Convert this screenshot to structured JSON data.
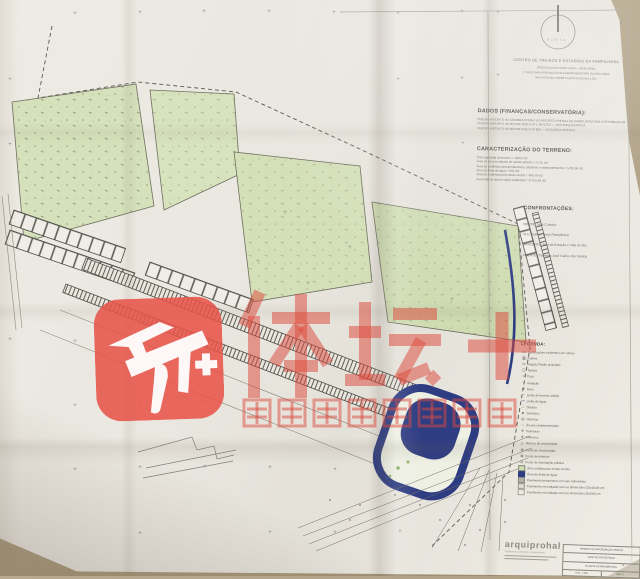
{
  "watermark": {
    "icon_name": "tiyu-tan-plus-app-icon",
    "main_text": "体坛+",
    "subtitle": "体坛周报新闻客户端",
    "color": "#dd4a3e"
  },
  "north": {
    "label": "NORTE"
  },
  "header": {
    "lines": [
      "CENTRO DE TREINOS E ESTÁGIOS DA PAMPILHOSA",
      "(FREGUESIA DA PAMPILHOSA — MEALHADA)",
      "1ª FASE PARA APROVAÇÃO NA CÂMARA MUNICIPAL DA MEALHADA",
      "IMPLANTAÇÃO SOBRE PLANTA À ESCALA 1:500"
    ]
  },
  "dados": {
    "title": "DADOS (FINANÇAS/CONSERVATÓRIA):",
    "lines": [
      "PRÉDIO INSCRITO NA CONSERVATÓRIA DO REGISTO PREDIAL DE PAMPILHOSA SOB O Nº 01821/91-03",
      "PRÉDIO INSCRITO NA MATRIZ SOB O Nº 1 SECÇÃO — NATUREZA RÚSTICA",
      "PRÉDIO INSCRITO NA MATRIZ SOB O Nº 820 — NATUREZA RÚSTICA"
    ]
  },
  "terreno": {
    "title": "CARACTERIZAÇÃO DO TERRENO:",
    "lines": [
      "Área registada do terreno = 49255 m2",
      "Área do terreno objecto do estudo anterior = 5755 m2",
      "Área de cedência para arruamentos, passeios e estacionamentos = 5782,36 m2",
      "Área da linha de água = 650 m2",
      "Área de cedência para zonas verdes = 968,70 m2",
      "Área final do terreno após cedências = 37755,36 m2"
    ]
  },
  "confrontacoes": {
    "title": "CONFRONTAÇÕES:",
    "lines": [
      "NORTE: José Curinha",
      "SUL: Rua do Brejo Pampilhosa",
      "NASCENTE: Rua da Estação e Vale do Rio",
      "POENTE: Travessa José Carlos dos Santos"
    ]
  },
  "legenda": {
    "title": "LEGENDA:",
    "items": [
      {
        "glyph": "▭",
        "chip": "",
        "label": "Construções existentes em ruínas"
      },
      {
        "glyph": "▥",
        "chip": "",
        "label": "Ruínas"
      },
      {
        "glyph": "═",
        "chip": "",
        "label": "Regato Pavão projetado"
      },
      {
        "glyph": "◻",
        "chip": "",
        "label": "Tanque"
      },
      {
        "glyph": "○",
        "chip": "",
        "label": "Poço"
      },
      {
        "glyph": "┈",
        "chip": "",
        "label": "Vedação"
      },
      {
        "glyph": "━",
        "chip": "",
        "label": "Muro"
      },
      {
        "glyph": "╌",
        "chip": "",
        "label": "Linha de terreno cedido"
      },
      {
        "glyph": "～",
        "chip": "blue",
        "label": "Linha de água"
      },
      {
        "glyph": "∴",
        "chip": "",
        "label": "Silvado"
      },
      {
        "glyph": "●",
        "chip": "",
        "label": "Sobreiros"
      },
      {
        "glyph": "◎",
        "chip": "",
        "label": "Oliveiras"
      },
      {
        "glyph": "◌",
        "chip": "",
        "label": "Árvores indeterminadas"
      },
      {
        "glyph": "✳",
        "chip": "",
        "label": "Palmeiras"
      },
      {
        "glyph": "✶",
        "chip": "",
        "label": "Pinheiros"
      },
      {
        "glyph": "△",
        "chip": "",
        "label": "Marcos de propriedade"
      },
      {
        "glyph": "⊕",
        "chip": "",
        "label": "Poste de electricidade"
      },
      {
        "glyph": "⊗",
        "chip": "",
        "label": "Poste de telefone"
      },
      {
        "glyph": "⊙",
        "chip": "",
        "label": "Poste de iluminação pública"
      },
      {
        "glyph": "",
        "chip": "chip-green",
        "label": "Área cedida para zonas verdes"
      },
      {
        "glyph": "",
        "chip": "chip-navy",
        "label": "Área da linha de água"
      },
      {
        "glyph": "",
        "chip": "chip-gray",
        "label": "Pavimento betuminoso em vias rodoviárias"
      },
      {
        "glyph": "",
        "chip": "chip-light",
        "label": "Pavimento em calçada com as dimensões (10x10x8) cm"
      },
      {
        "glyph": "",
        "chip": "chip-lighter",
        "label": "Pavimento em calçada com as dimensões (5x5x5) cm"
      }
    ]
  },
  "titleblock": {
    "logo": "arquiprohal",
    "tagline": "arquitectura, projectos e planeamento",
    "rows": [
      "PEDIDO DE INFORMAÇÃO PRÉVIA",
      "CENTRO DE ESTÁGIO",
      "PLANTA DE PAVIMENTOS"
    ],
    "scale": "ESC. 1:500",
    "sheet": "DES. 1"
  },
  "corner_marks": {
    "top_right": "1",
    "bottom_right": "4"
  },
  "colors": {
    "paper": "#eae7e0",
    "table": "#b0a083",
    "parcel_green": "#d5e1ba",
    "navy": "#2e3c82",
    "watermark_red": "#dd4a3e",
    "line_gray": "#5a5a52"
  },
  "crosses": [
    [
      75,
      14
    ],
    [
      140,
      13
    ],
    [
      204,
      12
    ],
    [
      269,
      12
    ],
    [
      334,
      13
    ],
    [
      398,
      14
    ],
    [
      462,
      12
    ],
    [
      498,
      13
    ],
    [
      10,
      80
    ],
    [
      398,
      80
    ],
    [
      462,
      79
    ],
    [
      498,
      76
    ],
    [
      10,
      145
    ],
    [
      463,
      144
    ],
    [
      285,
      213
    ],
    [
      350,
      248
    ],
    [
      258,
      262
    ],
    [
      308,
      284
    ],
    [
      452,
      300
    ],
    [
      10,
      340
    ],
    [
      75,
      342
    ],
    [
      75,
      406
    ],
    [
      140,
      404
    ],
    [
      205,
      403
    ],
    [
      75,
      470
    ],
    [
      140,
      468
    ],
    [
      205,
      467
    ],
    [
      270,
      468
    ],
    [
      335,
      470
    ],
    [
      140,
      534
    ],
    [
      270,
      533
    ],
    [
      335,
      533
    ],
    [
      400,
      532
    ]
  ]
}
